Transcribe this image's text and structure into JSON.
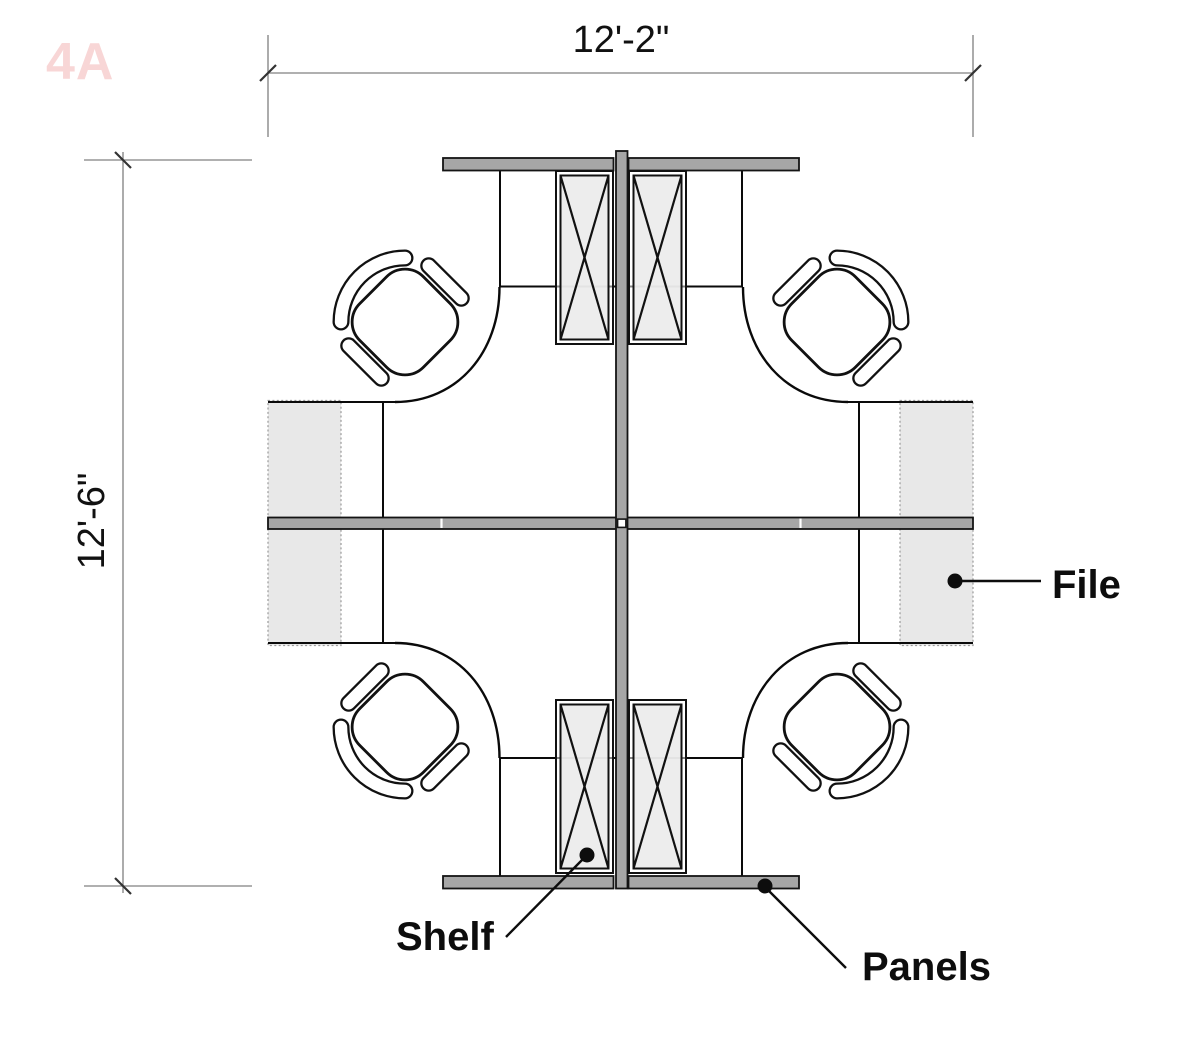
{
  "sheet": {
    "plan_code": "4A",
    "background": "#ffffff"
  },
  "dimensions": {
    "top": {
      "label": "12'-2\"",
      "orientation": "horizontal"
    },
    "left": {
      "label": "12'-6\"",
      "orientation": "vertical"
    }
  },
  "callouts": {
    "file": {
      "label": "File"
    },
    "shelf": {
      "label": "Shelf"
    },
    "panels": {
      "label": "Panels"
    }
  },
  "plan": {
    "type": "office-cubicle-cluster-plan",
    "workstation_count": 4,
    "chair_count": 4,
    "overhead_shelf_count": 4,
    "file_cabinet_count": 4,
    "panel_layout": "cross-spine with four wing panels"
  },
  "colors": {
    "panel_fill": "#a6a6a6",
    "shelf_fill": "#ececec",
    "file_fill": "#e8e8e8",
    "line": "#0a0a0a",
    "dimension_line": "#808080",
    "plan_code": "#f8d6d6"
  }
}
